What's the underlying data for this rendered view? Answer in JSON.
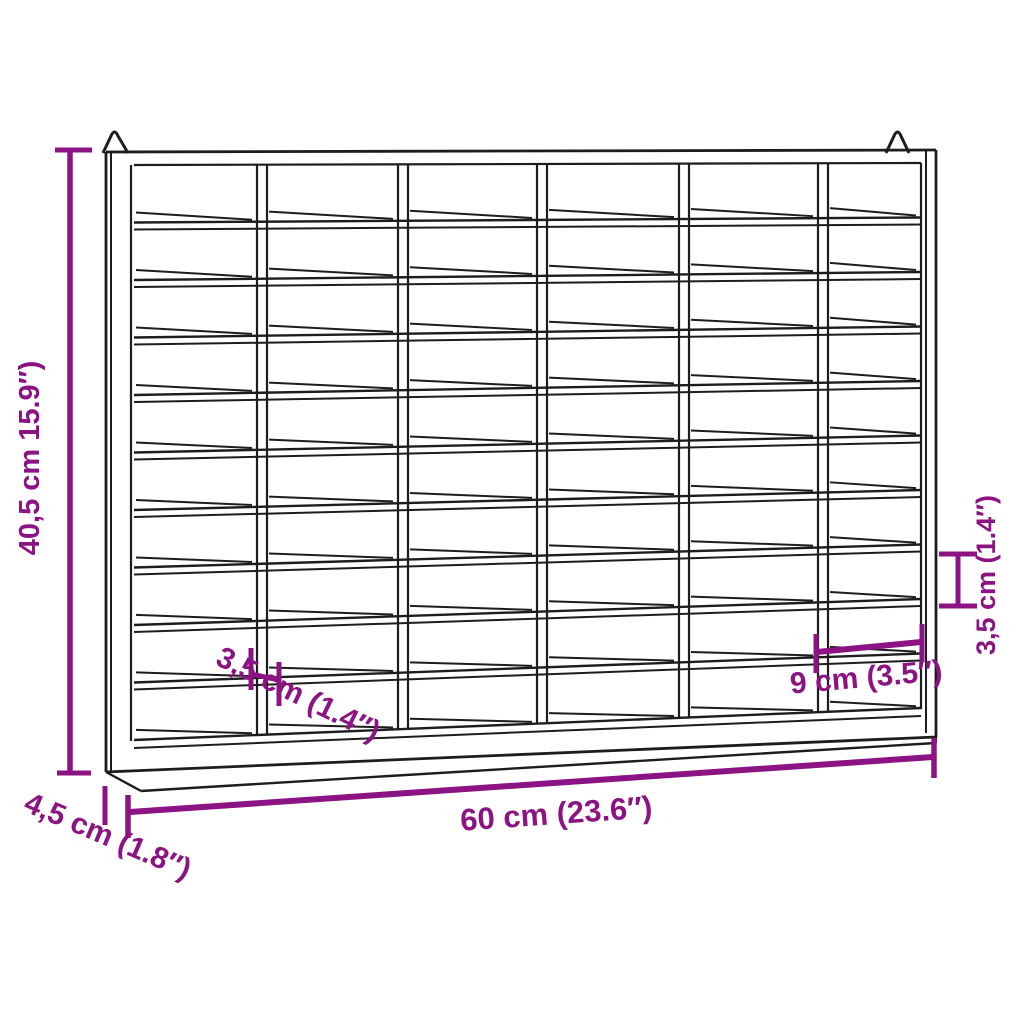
{
  "canvas": {
    "width": 1024,
    "height": 1024,
    "background": "#ffffff"
  },
  "style": {
    "accent_color": "#8c1383",
    "line_color": "#1d1d1d"
  },
  "unit": {
    "description": "Wall-mounted pigeonhole compartment shelf, technical line drawing in slight perspective",
    "rows": 10,
    "columns": 6,
    "compartments": 60,
    "hanging_hooks": 2
  },
  "dimension_labels": {
    "height": "40,5 cm 15.9″)",
    "width": "60 cm (23.6″)",
    "depth": "4,5 cm (1.8″)",
    "compartment_height_left": "3,5 cm (1.4″)",
    "compartment_height_right": "3,5 cm (1.4″)",
    "compartment_width": "9 cm (3.5″)"
  }
}
